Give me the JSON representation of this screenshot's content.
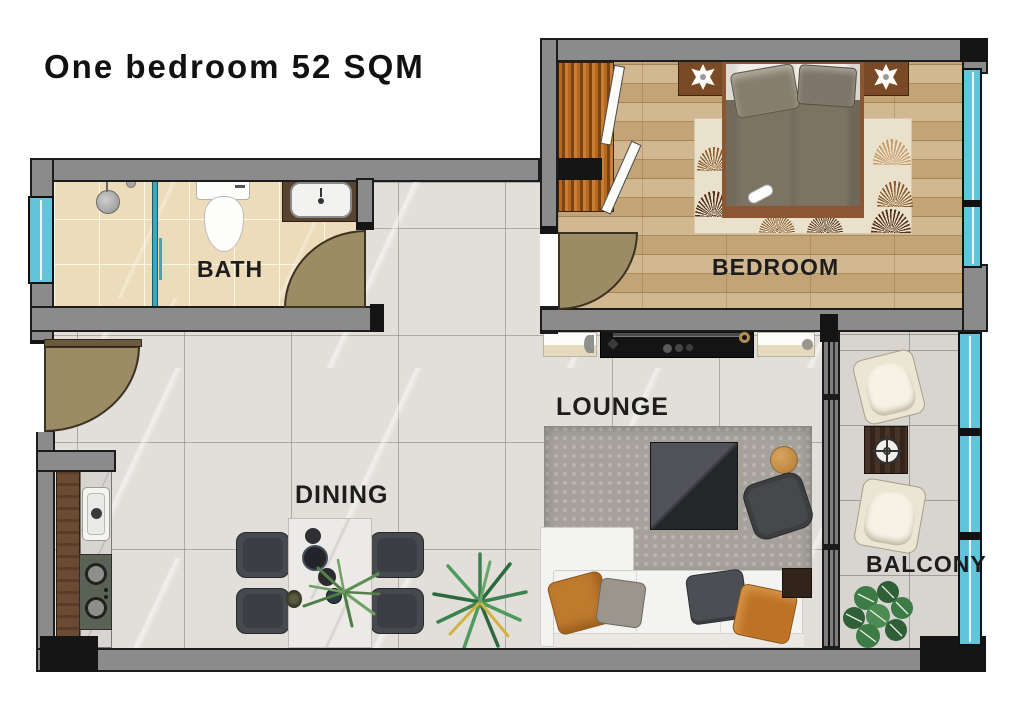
{
  "title": "One bedroom 52 SQM",
  "rooms": {
    "bath": {
      "label": "BATH"
    },
    "bedroom": {
      "label": "BEDROOM"
    },
    "lounge": {
      "label": "LOUNGE"
    },
    "dining": {
      "label": "DINING"
    },
    "balcony": {
      "label": "BALCONY"
    }
  },
  "legend_colors": {
    "wall_grey": "#8b8b8b",
    "structural_black": "#151515",
    "window_glass_cyan": "#62c3da",
    "door_swing_tan": "#9b8c66",
    "bath_tile_beige": "#ecdcba",
    "bedroom_wood": "#cdb083",
    "living_tile_grey": "#e2dfda",
    "balcony_tile_grey": "#d8d5d1"
  },
  "fixtures": {
    "bath": [
      "window",
      "shower",
      "shower-glass-panel",
      "toilet",
      "washbasin-on-counter",
      "door-swing"
    ],
    "bedroom": [
      "wardrobe",
      "double-bed",
      "pillows",
      "nightstand-left",
      "nightstand-right",
      "star-decor",
      "area-rug",
      "full-height-window",
      "door-swing"
    ],
    "lounge": [
      "tv-console",
      "tv",
      "side-cabinets",
      "shaggy-rug",
      "coffee-table",
      "round-side-table",
      "ottoman",
      "corner-sofa",
      "sofa-cushions",
      "sofa-side-table",
      "floor-plant"
    ],
    "dining": [
      "dining-table",
      "dining-chairs-x4",
      "table-decor",
      "aloe-plant"
    ],
    "kitchen": [
      "counter",
      "sink",
      "two-burner-hob"
    ],
    "balcony": [
      "armchair-x2",
      "small-table",
      "monstera-plant",
      "glass-railing",
      "sliding-door"
    ],
    "entry": [
      "entry-door-swing"
    ]
  }
}
